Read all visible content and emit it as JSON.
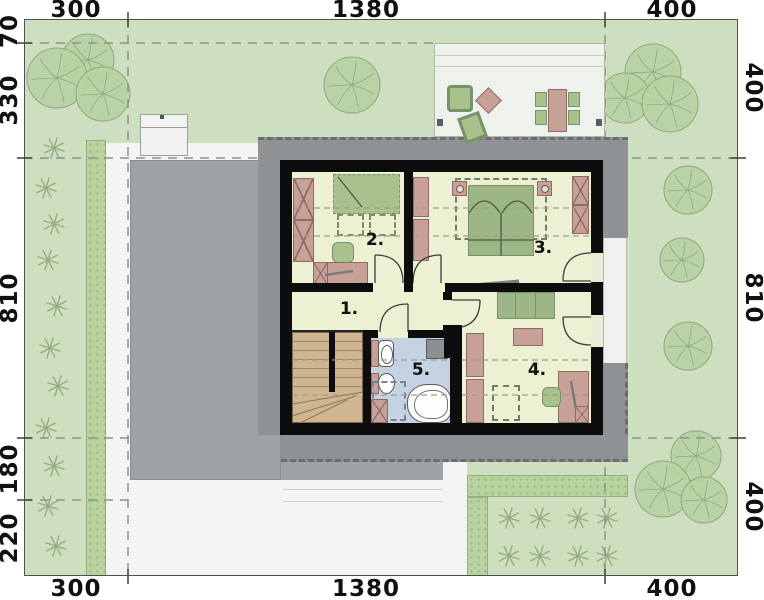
{
  "plan_title": "attic floor site plan",
  "dimensions": {
    "top": [
      "300",
      "1380",
      "400"
    ],
    "bottom": [
      "300",
      "1380",
      "400"
    ],
    "left": [
      "70",
      "330",
      "810",
      "180",
      "220"
    ],
    "right": [
      "400",
      "810",
      "400"
    ]
  },
  "rooms": [
    {
      "number": "1."
    },
    {
      "number": "2."
    },
    {
      "number": "3."
    },
    {
      "number": "4."
    },
    {
      "number": "5."
    }
  ],
  "colors": {
    "lawn": "#cddfbe",
    "hedge": "#b7d39e",
    "hardscape": "#f4f5f2",
    "garage": "#a0a3a5",
    "roof": "#8f9294",
    "wall": "#0d0d0d",
    "floor": "#edf0d3",
    "bath": "#c4d2e3",
    "mauve": "#c7a198",
    "furngreen": "#a9c18d",
    "stairs": "#cfb691",
    "terrace": "#eff1ed",
    "dashline": "#8b948b",
    "boundary": "#4f4f4f",
    "tree_fill": "#b8d2a3",
    "tree_stroke": "#8fa87d",
    "shrub": "#96ad85"
  },
  "vegetation": {
    "trees": [
      {
        "cx": 88,
        "cy": 60,
        "r": 26
      },
      {
        "cx": 57,
        "cy": 78,
        "r": 30
      },
      {
        "cx": 103,
        "cy": 94,
        "r": 27
      },
      {
        "cx": 352,
        "cy": 85,
        "r": 28
      },
      {
        "cx": 653,
        "cy": 72,
        "r": 28
      },
      {
        "cx": 625,
        "cy": 98,
        "r": 25
      },
      {
        "cx": 670,
        "cy": 104,
        "r": 28
      },
      {
        "cx": 688,
        "cy": 190,
        "r": 24
      },
      {
        "cx": 682,
        "cy": 260,
        "r": 22
      },
      {
        "cx": 688,
        "cy": 346,
        "r": 24
      },
      {
        "cx": 696,
        "cy": 456,
        "r": 25
      },
      {
        "cx": 663,
        "cy": 489,
        "r": 28
      },
      {
        "cx": 704,
        "cy": 500,
        "r": 23
      }
    ],
    "shrubs_left": [
      {
        "x": 54,
        "y": 148
      },
      {
        "x": 46,
        "y": 188
      },
      {
        "x": 54,
        "y": 224
      },
      {
        "x": 48,
        "y": 260
      },
      {
        "x": 57,
        "y": 306
      },
      {
        "x": 50,
        "y": 348
      },
      {
        "x": 58,
        "y": 386
      },
      {
        "x": 46,
        "y": 428
      },
      {
        "x": 54,
        "y": 466
      },
      {
        "x": 48,
        "y": 506
      },
      {
        "x": 56,
        "y": 546
      }
    ],
    "shrubs_garden": [
      {
        "x": 509,
        "y": 518
      },
      {
        "x": 540,
        "y": 518
      },
      {
        "x": 578,
        "y": 518
      },
      {
        "x": 607,
        "y": 518
      },
      {
        "x": 509,
        "y": 556
      },
      {
        "x": 540,
        "y": 556
      },
      {
        "x": 578,
        "y": 556
      },
      {
        "x": 607,
        "y": 556
      }
    ]
  }
}
